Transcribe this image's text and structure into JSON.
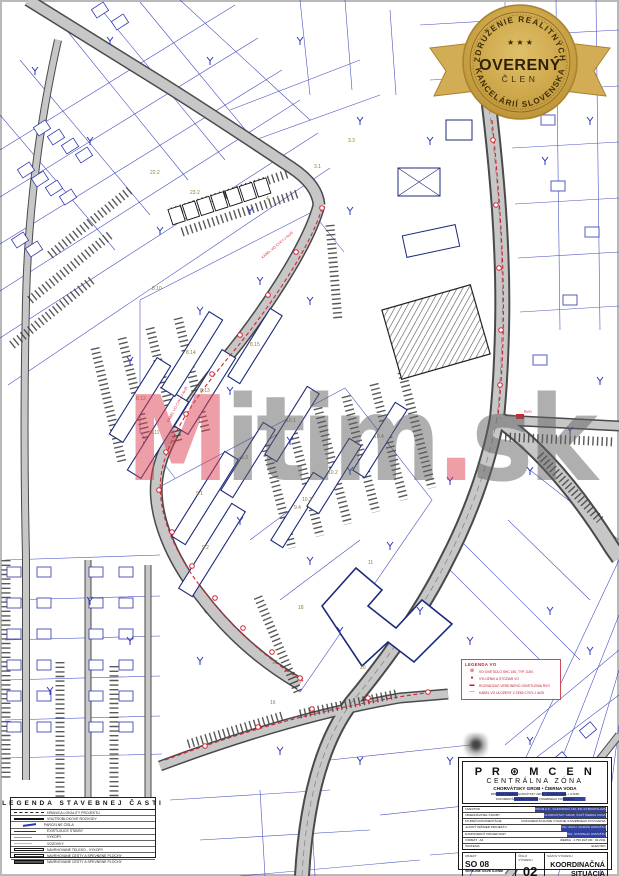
{
  "badge": {
    "arc_top": "ZDRUŽENIE REALITNÝCH",
    "arc_bottom": "KANCELÁRIÍ SLOVENSKA",
    "stars": "★ ★ ★",
    "title": "OVERENÝ",
    "subtitle": "ČLEN"
  },
  "watermark": {
    "p1": "M",
    "p2": "itim",
    "p3": ".",
    "p4": "sk"
  },
  "map": {
    "area_labels": [
      {
        "text": "22.2",
        "x": 150,
        "y": 170
      },
      {
        "text": "23.2",
        "x": 190,
        "y": 190
      },
      {
        "text": "4",
        "x": 266,
        "y": 196
      },
      {
        "text": "3.1",
        "x": 314,
        "y": 164
      },
      {
        "text": "3.3",
        "x": 348,
        "y": 138
      },
      {
        "text": "8.10",
        "x": 152,
        "y": 286
      },
      {
        "text": "8.14",
        "x": 186,
        "y": 350
      },
      {
        "text": "8.13",
        "x": 200,
        "y": 388
      },
      {
        "text": "8.12",
        "x": 136,
        "y": 396
      },
      {
        "text": "8.11",
        "x": 150,
        "y": 430
      },
      {
        "text": "8.15",
        "x": 250,
        "y": 342
      },
      {
        "text": "10.1",
        "x": 286,
        "y": 418
      },
      {
        "text": "10.4",
        "x": 374,
        "y": 434
      },
      {
        "text": "10.2",
        "x": 328,
        "y": 470
      },
      {
        "text": "10.3",
        "x": 302,
        "y": 497
      },
      {
        "text": "9.3",
        "x": 241,
        "y": 455
      },
      {
        "text": "9.1",
        "x": 196,
        "y": 491
      },
      {
        "text": "9.2",
        "x": 202,
        "y": 545
      },
      {
        "text": "9.4",
        "x": 294,
        "y": 505
      },
      {
        "text": "11",
        "x": 368,
        "y": 560
      },
      {
        "text": "18",
        "x": 298,
        "y": 605
      },
      {
        "text": "20",
        "x": 360,
        "y": 665
      },
      {
        "text": "17",
        "x": 272,
        "y": 660
      },
      {
        "text": "16",
        "x": 270,
        "y": 700
      }
    ],
    "red_notes": [
      {
        "text": "KÁBEL VO CYKY-J 4x25",
        "x": 262,
        "y": 256,
        "rot": -40
      },
      {
        "text": "KÁBEL VO CYKY-J 4x25",
        "x": 168,
        "y": 420,
        "rot": -62
      },
      {
        "text": "RVO",
        "x": 524,
        "y": 410,
        "rot": 0
      }
    ]
  },
  "vo_legend": {
    "title": "LEGENDA VO",
    "rows": [
      {
        "glyph": "⊗",
        "text": "VO SVIETIDLO SHC 150, TYP. OZN."
      },
      {
        "glyph": "●",
        "text": "VÝLOŽNÍK A STOŽIAR VO"
      },
      {
        "glyph": "▬",
        "text": "ROZVÁDZAČ VEREJNÉHO OSVETLENIA RVO"
      },
      {
        "glyph": "—",
        "text": "KÁBEL VO ULOŽENÝ V ZEMI CYKY-J 4x25"
      }
    ]
  },
  "legend": {
    "title": "LEGENDA STAVEBNEJ ČASTI",
    "rows": [
      {
        "type": "dashed",
        "label": "HRANICA LOKALITY PROJEKTU"
      },
      {
        "type": "thick",
        "label": "VNÚTROBLOKOVÉ ROZVODY"
      },
      {
        "type": "blue",
        "label": "PARCELNÉ ČÍSLA"
      },
      {
        "type": "thin",
        "label": "EXISTUJÚCE STAVBY"
      },
      {
        "type": "gray",
        "label": "VÝKOPY"
      },
      {
        "type": "gray2",
        "label": "VOZOVKY"
      },
      {
        "type": "rect-outline",
        "label": "NAVRHOVANÉ TELESO - VÝKOPY"
      },
      {
        "type": "rect-hatch",
        "label": "NAVRHOVANÉ CESTY A SPEVNENÉ PLOCHY"
      },
      {
        "type": "rect-fill",
        "label": "NAVRHOVANÉ CESTY A SPEVNENÉ PLOCHY"
      }
    ]
  },
  "titleblock": {
    "logo": "P R ⊛ M C E N",
    "line2": "CENTRÁLNA ZÓNA",
    "line3": "CHORVÁTSKY GROB • ČIERNA VODA",
    "line4": "PRÍPRAVA ÚZEMIA CHORVÁTSKY GROB – ČIERNA VODA, I. ETAPA",
    "line5": "DOKUMENTÁCIA PRE VYDANIE STAVEBNÉHO POVOLENIA",
    "info_rows": [
      {
        "label": "INVESTOR",
        "value": "PROM A.S., VAJNORSKÁ 136, 831 04 BRATISLAVA"
      },
      {
        "label": "OBJEDNÁVATEĽ STAVBY",
        "value": "CHORVÁTSKY GROB, ČASŤ ČIERNA VODA"
      },
      {
        "label": "STUPEŇ DOKUMENTÁCIE",
        "value": "DOKUMENTÁCIA PRE VYDANIE STAVEBNÉHO POVOLENIA"
      },
      {
        "label": "HLAVNÝ INŽINIER PROJEKTU",
        "value": "ING. ARCH. MARIÁN HORVÁTH"
      },
      {
        "label": "ZODPOVEDNÝ PROJEKTANT",
        "value": "ING. STANISLAV HORVÁTH"
      },
      {
        "label": "FORMÁT : A2",
        "value": "MIERKA : 1:750    DÁTUM : 04.2011"
      },
      {
        "label": "PROFESIA",
        "value": "ELEKTRO"
      }
    ],
    "bottom": {
      "col1_label": "OBJEKT",
      "col1_value": "SO 08",
      "col1_sub": "VEREJNÉ OSVETLENIE",
      "col2_label": "ČÍSLO VÝKRESU",
      "col2_value": "02",
      "col3_label": "NÁZOV VÝKRESU",
      "col3_value": "KOORDINAČNÁ SITUÁCIA"
    }
  }
}
